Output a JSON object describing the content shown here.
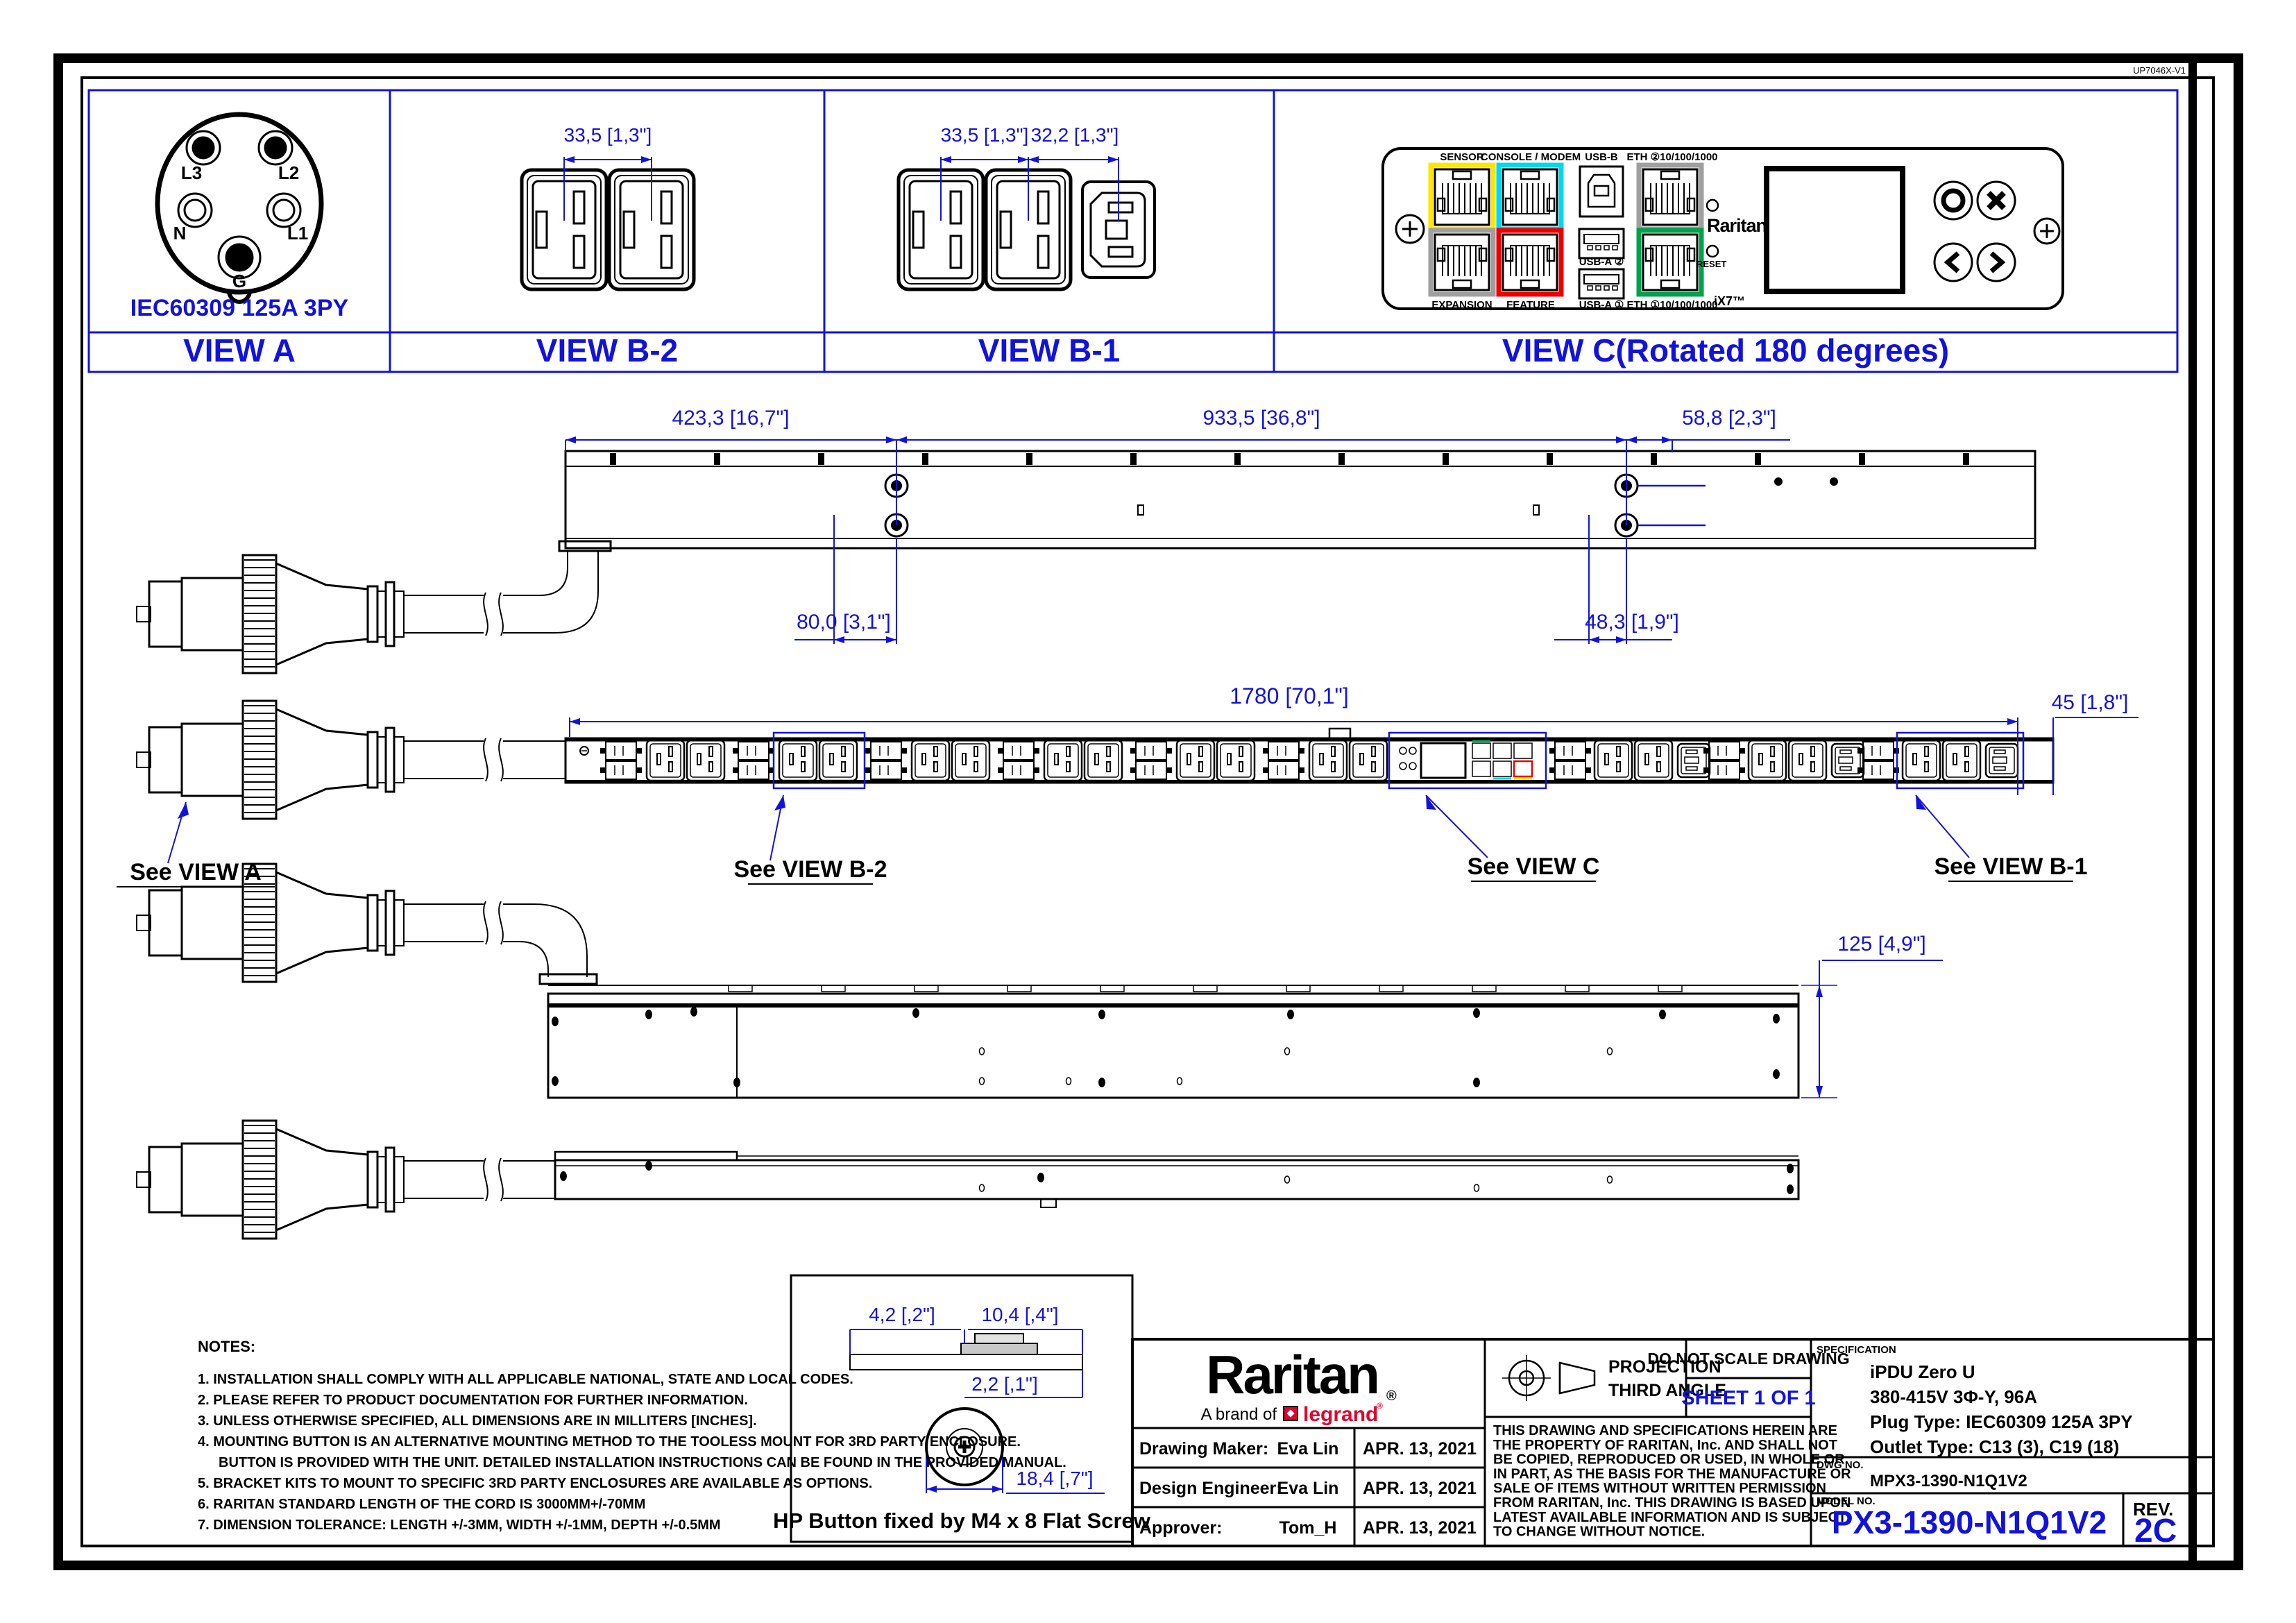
{
  "doc": {
    "corner_code": "UP7046X-V1"
  },
  "colors": {
    "blue": "#1212dd",
    "black": "#000000",
    "port_yellow": "#ffe600",
    "port_cyan": "#00d8ee",
    "port_red": "#ee0000",
    "port_gray": "#9f9f9f",
    "port_green": "#00a14b",
    "legrand_red": "#e4002b"
  },
  "views": {
    "view_a": {
      "label": "VIEW A",
      "caption": "IEC60309 125A 3PY",
      "pin_labels": [
        "L3",
        "L2",
        "N",
        "L1",
        "G"
      ]
    },
    "view_b2": {
      "label": "VIEW B-2",
      "dim1": "33,5 [1,3\"]"
    },
    "view_b1": {
      "label": "VIEW B-1",
      "dim1": "33,5 [1,3\"]",
      "dim2": "32,2 [1,3\"]"
    },
    "view_c": {
      "label": "VIEW C(Rotated 180 degrees)",
      "ports_top": [
        "SENSOR",
        "CONSOLE / MODEM",
        "USB-B",
        "ETH ②10/100/1000"
      ],
      "ports_bottom": [
        "EXPANSION",
        "FEATURE",
        "USB-A ①",
        "ETH ①10/100/1000"
      ],
      "usb_a2": "USB-A ②",
      "reset": "RESET",
      "brand": "Raritan",
      "ix7": "iX7™"
    }
  },
  "view1": {
    "dims_top": [
      "423,3 [16,7\"]",
      "933,5 [36,8\"]",
      "58,8 [2,3\"]"
    ],
    "dims_bottom": [
      "80,0 [3,1\"]",
      "48,3 [1,9\"]"
    ]
  },
  "view2": {
    "dim_length": "1780 [70,1\"]",
    "dim_right": "45 [1,8\"]",
    "see": [
      "See VIEW A",
      "See VIEW B-2",
      "See VIEW C",
      "See VIEW B-1"
    ]
  },
  "view3": {
    "dim_height": "125 [4,9\"]"
  },
  "hp_button": {
    "dims": [
      "4,2 [,2\"]",
      "10,4 [,4\"]",
      "2,2 [,1\"]",
      "18,4 [,7\"]"
    ],
    "caption": "HP Button fixed by M4 x 8 Flat Screw"
  },
  "notes": {
    "title": "NOTES:",
    "lines": [
      "1. INSTALLATION SHALL COMPLY WITH ALL APPLICABLE NATIONAL, STATE AND LOCAL CODES.",
      "2. PLEASE REFER TO PRODUCT DOCUMENTATION FOR FURTHER INFORMATION.",
      "3. UNLESS OTHERWISE SPECIFIED, ALL DIMENSIONS ARE IN MILLITERS [INCHES].",
      "4. MOUNTING BUTTON IS AN ALTERNATIVE MOUNTING METHOD TO THE TOOLESS MOUNT FOR 3RD PARTY ENCLOSURE.",
      "BUTTON IS PROVIDED WITH THE UNIT. DETAILED INSTALLATION INSTRUCTIONS CAN BE FOUND IN THE PROVIDED MANUAL.",
      "5. BRACKET KITS TO MOUNT TO SPECIFIC 3RD PARTY ENCLOSURES ARE AVAILABLE AS OPTIONS.",
      "6. RARITAN STANDARD LENGTH OF THE CORD IS 3000MM+/-70MM",
      "7. DIMENSION TOLERANCE: LENGTH +/-3MM, WIDTH +/-1MM, DEPTH +/-0.5MM"
    ]
  },
  "title_block": {
    "brand": "Raritan",
    "reg": "®",
    "brand_prefix": "A brand of",
    "legrand": "legrand",
    "legrand_reg": "®",
    "approvals": [
      {
        "role": "Drawing Maker:",
        "name": "Eva Lin",
        "date": "APR. 13, 2021"
      },
      {
        "role": "Design Engineer:",
        "name": "Eva Lin",
        "date": "APR. 13, 2021"
      },
      {
        "role": "Approver:",
        "name": "Tom_H",
        "date": "APR. 13, 2021"
      }
    ],
    "projection1": "PROJECTION",
    "projection2": "THIRD ANGLE",
    "do_not_scale": "DO NOT SCALE DRAWING",
    "sheet": "SHEET 1 OF 1",
    "legal": [
      "THIS DRAWING AND SPECIFICATIONS HEREIN ARE",
      "THE PROPERTY OF RARITAN, Inc. AND SHALL NOT",
      "BE COPIED, REPRODUCED OR USED, IN WHOLE OR",
      "IN PART, AS THE BASIS FOR THE MANUFACTURE OR",
      "SALE OF ITEMS WITHOUT WRITTEN PERMISSION",
      "FROM RARITAN, Inc. THIS DRAWING IS BASED UPON",
      "LATEST AVAILABLE INFORMATION AND IS SUBJECT",
      "TO CHANGE WITHOUT NOTICE."
    ],
    "spec_label": "SPECIFICATION",
    "spec": [
      "iPDU Zero U",
      "380-415V 3Φ-Y, 96A",
      "Plug Type: IEC60309 125A 3PY",
      "Outlet Type: C13 (3), C19 (18)"
    ],
    "dwg_label": "DWG NO.",
    "dwg_no": "MPX3-1390-N1Q1V2",
    "model_label": "MODEL NO.",
    "model_no": "PX3-1390-N1Q1V2",
    "rev_label": "REV.",
    "rev": "2C"
  }
}
